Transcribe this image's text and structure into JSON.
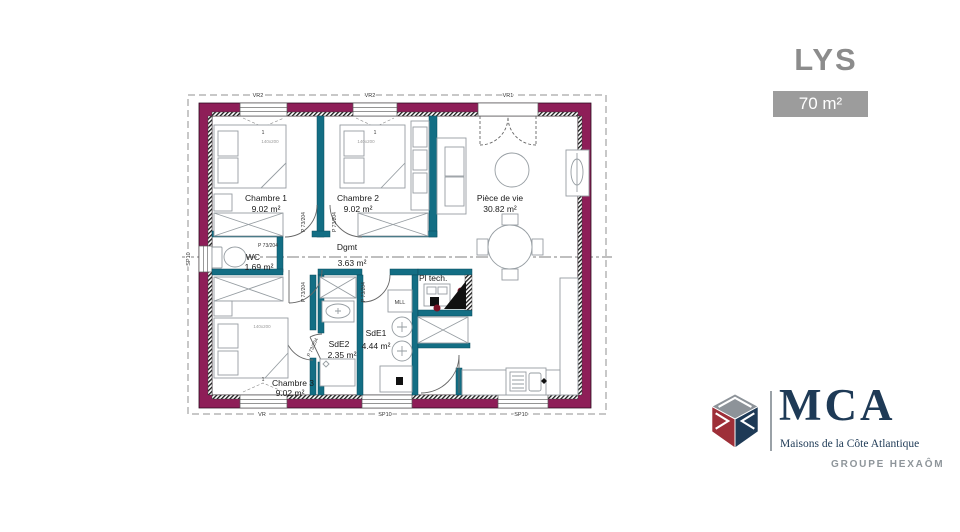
{
  "header": {
    "title": "LYS",
    "area_badge": "70 m²"
  },
  "plan": {
    "rooms": [
      {
        "name": "Chambre 1",
        "area": "9.02 m²"
      },
      {
        "name": "Chambre 2",
        "area": "9.02 m²"
      },
      {
        "name": "Pièce de vie",
        "area": "30.82 m²"
      },
      {
        "name": "Dgmt",
        "area": "3.63 m²"
      },
      {
        "name": "WC",
        "area": "1.69 m²"
      },
      {
        "name": "SdE2",
        "area": "2.35 m²"
      },
      {
        "name": "SdE1",
        "area": "4.44 m²"
      },
      {
        "name": "Chambre 3",
        "area": "9.02 m²"
      },
      {
        "name": "Pl tech.",
        "area": ""
      }
    ],
    "labels": {
      "door": "P 73/204",
      "bed_size": "140x200",
      "washing_machine": "MLL",
      "pane": "1"
    },
    "openings": {
      "window_top_left": "VR2",
      "window_top_center": "VR2",
      "entry": "VR1",
      "window_wc": "SP10",
      "window_ch3": "VR",
      "window_sde1": "SP10",
      "window_kitchen": "SP10"
    }
  },
  "branding": {
    "acronym": "MCA",
    "company": "Maisons de la Côte Atlantique",
    "group": "GROUPE HEXAÔM"
  },
  "colors": {
    "wall": "#8e1e58",
    "partition": "#136e84",
    "title_gray": "#8c8c8c",
    "badge_bg": "#9c9c9c",
    "brand_navy": "#1e3a56",
    "brand_red": "#9e2f38",
    "brand_gray": "#8d9399"
  }
}
